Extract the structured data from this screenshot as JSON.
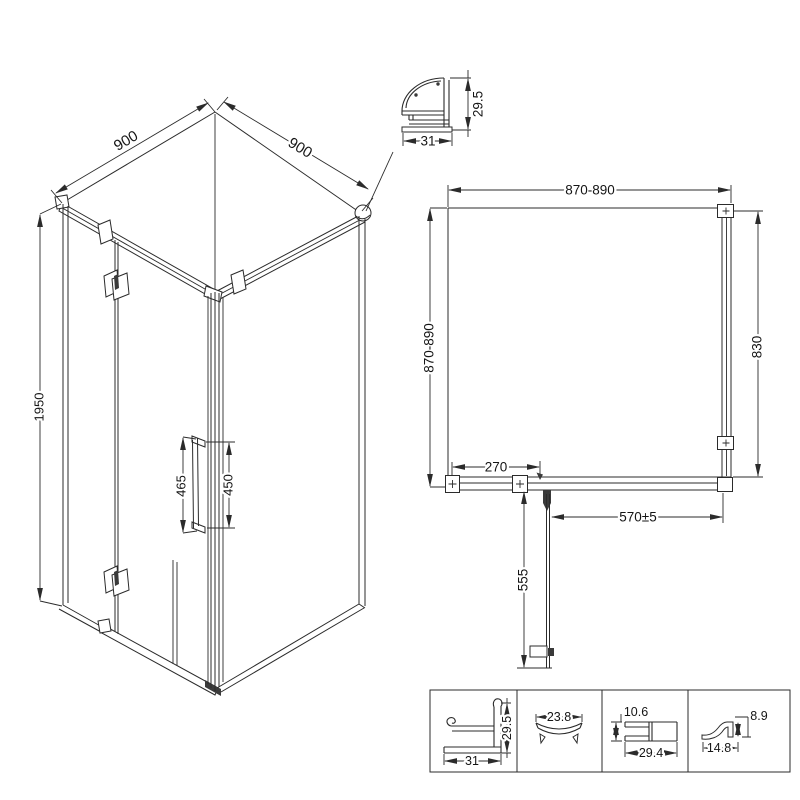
{
  "drawing": {
    "title": "shower-enclosure-technical-drawing",
    "iso_view": {
      "dim_width_left": "900",
      "dim_width_right": "900",
      "dim_height": "1950",
      "dim_handle_length": "465",
      "dim_handle_centers": "450"
    },
    "corner_profile": {
      "dim_width": "31",
      "dim_height": "29.5"
    },
    "plan_view": {
      "dim_width_top": "870-890",
      "dim_depth_left": "870-890",
      "dim_panel_right": "830",
      "dim_hinge_offset": "270",
      "dim_door_opening": "570±5",
      "dim_door_width": "555"
    },
    "profiles": [
      {
        "id": "wall-profile",
        "dim_width": "31",
        "dim_height": "29.5"
      },
      {
        "id": "curved-glass-profile",
        "dim_width": "23.8"
      },
      {
        "id": "frame-tube-profile",
        "dim_height": "10.6",
        "dim_width": "29.4"
      },
      {
        "id": "seal-profile",
        "dim_height": "8.9",
        "dim_width": "14.8"
      }
    ]
  },
  "colors": {
    "line": "#2b2b2b",
    "background": "#ffffff",
    "dark_fill": "#3a3a3a"
  }
}
